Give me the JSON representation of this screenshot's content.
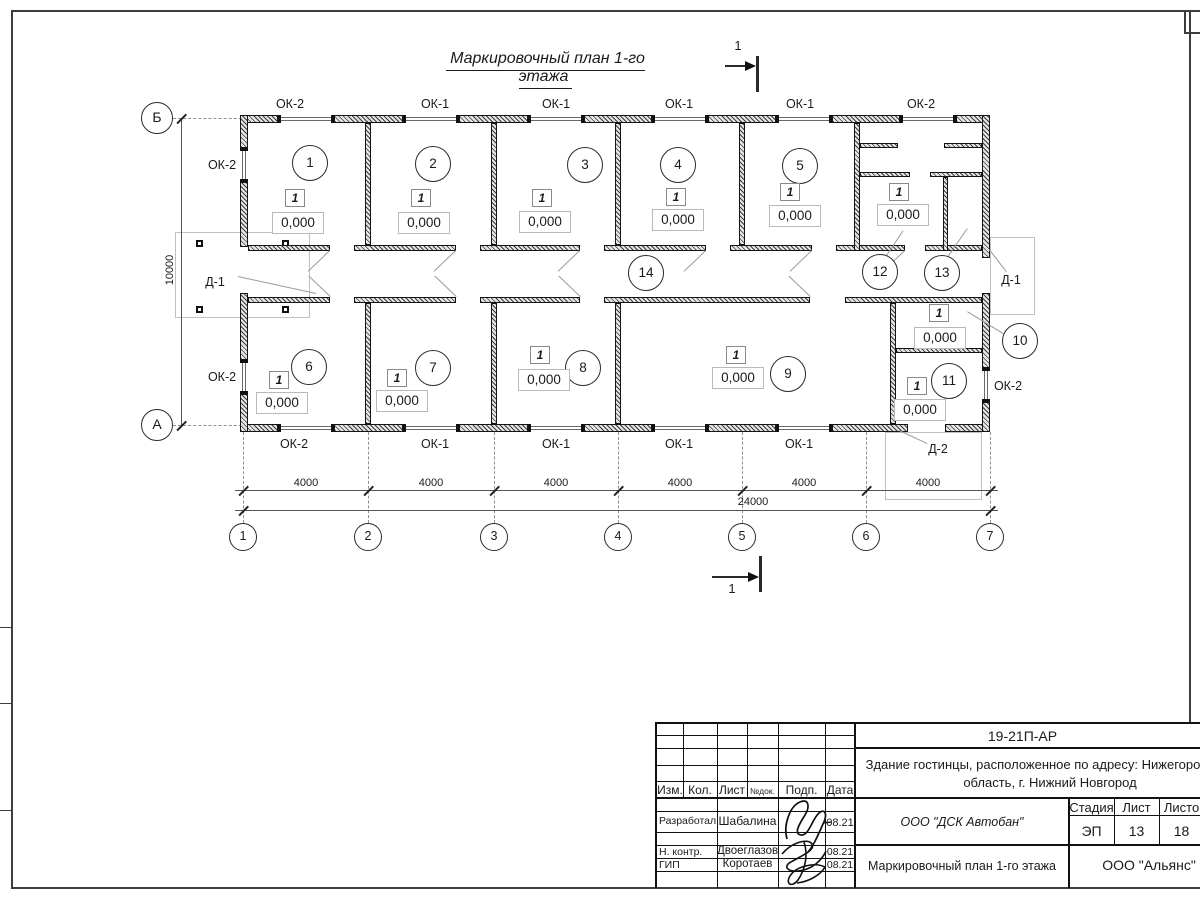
{
  "title": "Маркировочный план 1-го этажа",
  "section_label": "1",
  "colors": {
    "line": "#1a1a1a",
    "hatch": "#3c3c3c",
    "leader": "#9b9b9b"
  },
  "plan": {
    "window_labels": [
      {
        "text": "ОК-2",
        "x": 290,
        "y": 97
      },
      {
        "text": "ОК-1",
        "x": 435,
        "y": 97
      },
      {
        "text": "ОК-1",
        "x": 556,
        "y": 97
      },
      {
        "text": "ОК-1",
        "x": 679,
        "y": 97
      },
      {
        "text": "ОК-1",
        "x": 800,
        "y": 97
      },
      {
        "text": "ОК-2",
        "x": 921,
        "y": 97
      },
      {
        "text": "ОК-2",
        "x": 294,
        "y": 437
      },
      {
        "text": "ОК-1",
        "x": 435,
        "y": 437
      },
      {
        "text": "ОК-1",
        "x": 556,
        "y": 437
      },
      {
        "text": "ОК-1",
        "x": 679,
        "y": 437
      },
      {
        "text": "ОК-1",
        "x": 799,
        "y": 437
      },
      {
        "text": "ОК-2",
        "x": 222,
        "y": 158
      },
      {
        "text": "ОК-2",
        "x": 222,
        "y": 370
      },
      {
        "text": "ОК-2",
        "x": 1008,
        "y": 379
      }
    ],
    "door_labels": [
      {
        "text": "Д-1",
        "x": 215,
        "y": 275
      },
      {
        "text": "Д-1",
        "x": 1011,
        "y": 273
      },
      {
        "text": "Д-2",
        "x": 938,
        "y": 442
      }
    ],
    "rooms": [
      {
        "num": "1",
        "cx": 310,
        "cy": 163,
        "mark": "1",
        "mx": 295,
        "my": 198,
        "elev": "0,000",
        "ex": 298,
        "ey": 223
      },
      {
        "num": "2",
        "cx": 433,
        "cy": 164,
        "mark": "1",
        "mx": 421,
        "my": 198,
        "elev": "0,000",
        "ex": 424,
        "ey": 223
      },
      {
        "num": "3",
        "cx": 585,
        "cy": 165,
        "mark": "1",
        "mx": 542,
        "my": 198,
        "elev": "0,000",
        "ex": 545,
        "ey": 222
      },
      {
        "num": "4",
        "cx": 678,
        "cy": 165,
        "mark": "1",
        "mx": 676,
        "my": 197,
        "elev": "0,000",
        "ex": 678,
        "ey": 220
      },
      {
        "num": "5",
        "cx": 800,
        "cy": 166,
        "mark": "1",
        "mx": 790,
        "my": 192,
        "elev": "0,000",
        "ex": 795,
        "ey": 216
      },
      {
        "num": "6",
        "cx": 309,
        "cy": 367,
        "mark": "1",
        "mx": 279,
        "my": 380,
        "elev": "0,000",
        "ex": 282,
        "ey": 403
      },
      {
        "num": "7",
        "cx": 433,
        "cy": 368,
        "mark": "1",
        "mx": 397,
        "my": 378,
        "elev": "0,000",
        "ex": 402,
        "ey": 401
      },
      {
        "num": "8",
        "cx": 583,
        "cy": 368,
        "mark": "1",
        "mx": 540,
        "my": 355,
        "elev": "0,000",
        "ex": 544,
        "ey": 380
      },
      {
        "num": "9",
        "cx": 788,
        "cy": 374,
        "mark": "1",
        "mx": 736,
        "my": 355,
        "elev": "0,000",
        "ex": 738,
        "ey": 378
      },
      {
        "num": "10",
        "cx": 1020,
        "cy": 341,
        "mark": "1",
        "mx": 939,
        "my": 313,
        "elev": "0,000",
        "ex": 940,
        "ey": 338
      },
      {
        "num": "11",
        "cx": 949,
        "cy": 381,
        "mark": "1",
        "mx": 917,
        "my": 386,
        "elev": "0,000",
        "ex": 920,
        "ey": 410
      },
      {
        "num": "12",
        "cx": 880,
        "cy": 272,
        "mark": "1",
        "mx": 899,
        "my": 192,
        "elev": "0,000",
        "ex": 903,
        "ey": 215
      },
      {
        "num": "13",
        "cx": 942,
        "cy": 273
      },
      {
        "num": "14",
        "cx": 646,
        "cy": 273
      }
    ],
    "axes_bottom": [
      {
        "n": "1",
        "x": 243
      },
      {
        "n": "2",
        "x": 368
      },
      {
        "n": "3",
        "x": 494
      },
      {
        "n": "4",
        "x": 618
      },
      {
        "n": "5",
        "x": 742
      },
      {
        "n": "6",
        "x": 866
      },
      {
        "n": "7",
        "x": 990
      }
    ],
    "axes_left": [
      {
        "n": "Б",
        "y": 118
      },
      {
        "n": "А",
        "y": 425
      }
    ],
    "dim_segments": [
      {
        "text": "4000",
        "x": 306
      },
      {
        "text": "4000",
        "x": 431
      },
      {
        "text": "4000",
        "x": 556
      },
      {
        "text": "4000",
        "x": 680
      },
      {
        "text": "4000",
        "x": 804
      },
      {
        "text": "4000",
        "x": 928
      }
    ],
    "dim_total": "24000",
    "dim_vertical": "10000"
  },
  "titleblock": {
    "code": "19-21П-АР",
    "object_lines": [
      "Здание гостинцы, расположенное по адресу: Нижегородская",
      "область, г. Нижний Новгород"
    ],
    "header_cols": [
      "Изм.",
      "Кол.",
      "Лист",
      "№док.",
      "Подп.",
      "Дата"
    ],
    "rows": [
      {
        "role": "Разработал",
        "name": "Шабалина",
        "date": "08.21"
      },
      {
        "role": "Н. контр.",
        "name": "Двоеглазов",
        "date": "08.21"
      },
      {
        "role": "ГИП",
        "name": "Коротаев",
        "date": "08.21"
      }
    ],
    "org1": "ООО \"ДСК Автобан\"",
    "stage_label": "Стадия",
    "sheet_label": "Лист",
    "sheets_label": "Листов",
    "stage": "ЭП",
    "sheet_no": "13",
    "sheets_total": "18",
    "drawing_name": "Маркировочный план 1-го этажа",
    "org2": "ООО \"Альянс\""
  }
}
